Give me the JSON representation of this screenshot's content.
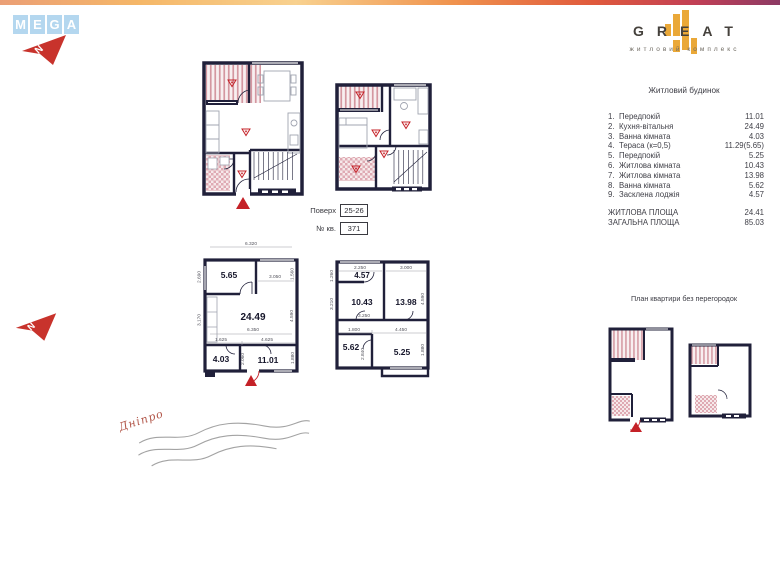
{
  "palette": {
    "wall": "#20203a",
    "mega_blue": "#b4d7ef",
    "great_orange": "#eaa838",
    "arrow_red": "#c42127",
    "hatch_pink": "#d497a0"
  },
  "brand": {
    "mega": {
      "letters": [
        "M",
        "E",
        "G",
        "A"
      ]
    },
    "great": {
      "title": "GREAT",
      "subtitle": "житловий комплекс"
    }
  },
  "compass": {
    "letter": "N"
  },
  "meta": {
    "floor_label": "Поверх",
    "floor_value": "25-26",
    "apt_label": "№ кв.",
    "apt_value": "371"
  },
  "room_list": {
    "title": "Житловий будинок",
    "items": [
      {
        "num": "1.",
        "name": "Передпокій",
        "value": "11.01"
      },
      {
        "num": "2.",
        "name": "Кухня-вітальня",
        "value": "24.49"
      },
      {
        "num": "3.",
        "name": "Ванна кімната",
        "value": "4.03"
      },
      {
        "num": "4.",
        "name": "Тераса (к=0,5)",
        "value": "11.29(5.65)"
      },
      {
        "num": "5.",
        "name": "Передпокій",
        "value": "5.25"
      },
      {
        "num": "6.",
        "name": "Житлова кімната",
        "value": "10.43"
      },
      {
        "num": "7.",
        "name": "Житлова кімната",
        "value": "13.98"
      },
      {
        "num": "8.",
        "name": "Ванна кімната",
        "value": "5.62"
      },
      {
        "num": "9.",
        "name": "Засклена лоджія",
        "value": "4.57"
      }
    ],
    "totals": [
      {
        "name": "ЖИТЛОВА ПЛОЩА",
        "value": "24.41"
      },
      {
        "name": "ЗАГАЛЬНА ПЛОЩА",
        "value": "85.03"
      }
    ]
  },
  "plans": {
    "no_partitions_title": "План квартири без перегородок",
    "lower": {
      "rooms": {
        "terrace": "5.65",
        "living": "24.49",
        "bath": "4.03",
        "hall": "11.01"
      },
      "dims": {
        "top": "6.320",
        "top_right": "1.560",
        "opening": "3.050",
        "left_upper": "2.690",
        "left_lower": "3.170",
        "right": "4.590",
        "mid": "6.350",
        "bottom_left": "1.625",
        "bottom_right": "4.625",
        "right_lower": "1.880",
        "entry": "2.060"
      }
    },
    "upper": {
      "rooms": {
        "loggia": "4.57",
        "room1": "10.43",
        "room2": "13.98",
        "bath": "5.62",
        "hall": "5.25"
      },
      "dims": {
        "top_left": "2.250",
        "top_right": "3.000",
        "left_top": "1.260",
        "left": "3.210",
        "right": "4.590",
        "mid": "3.250",
        "bottom_left": "1.800",
        "bottom_right": "4.450",
        "left_lower": "2.840",
        "right_lower": "1.880"
      }
    }
  },
  "river": {
    "name": "Дніпро"
  }
}
